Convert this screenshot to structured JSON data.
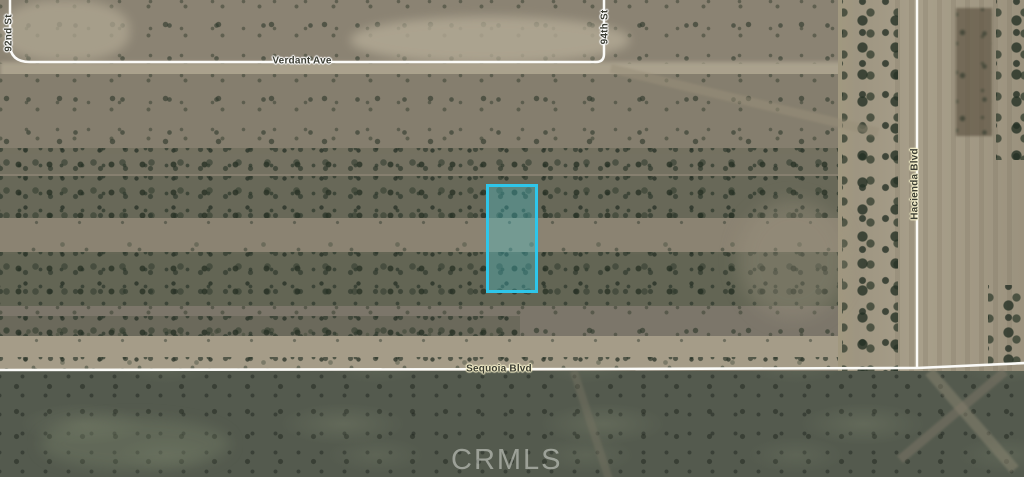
{
  "map": {
    "watermark": "CRMLS",
    "roads": {
      "ninety_second": {
        "name": "92nd St",
        "orientation": "vertical"
      },
      "verdant": {
        "name": "Verdant Ave",
        "orientation": "horizontal"
      },
      "ninety_fourth": {
        "name": "94th St",
        "orientation": "vertical"
      },
      "hacienda": {
        "name": "Hacienda Blvd",
        "orientation": "vertical"
      },
      "sequoia": {
        "name": "Sequoia Blvd",
        "orientation": "horizontal"
      }
    },
    "parcel": {
      "border_color": "#2ec6ea",
      "fill_color": "rgba(70,200,214,0.33)"
    },
    "colors": {
      "road_line": "#fbfbf8",
      "label_text": "#3b3d33",
      "label_halo_white": "#ffffff",
      "label_halo_cream": "#f5efca",
      "terrain_base": "#867f6f",
      "terrain_dark_band": "#545a4e",
      "dirt_corridor": "#a59c88"
    }
  }
}
